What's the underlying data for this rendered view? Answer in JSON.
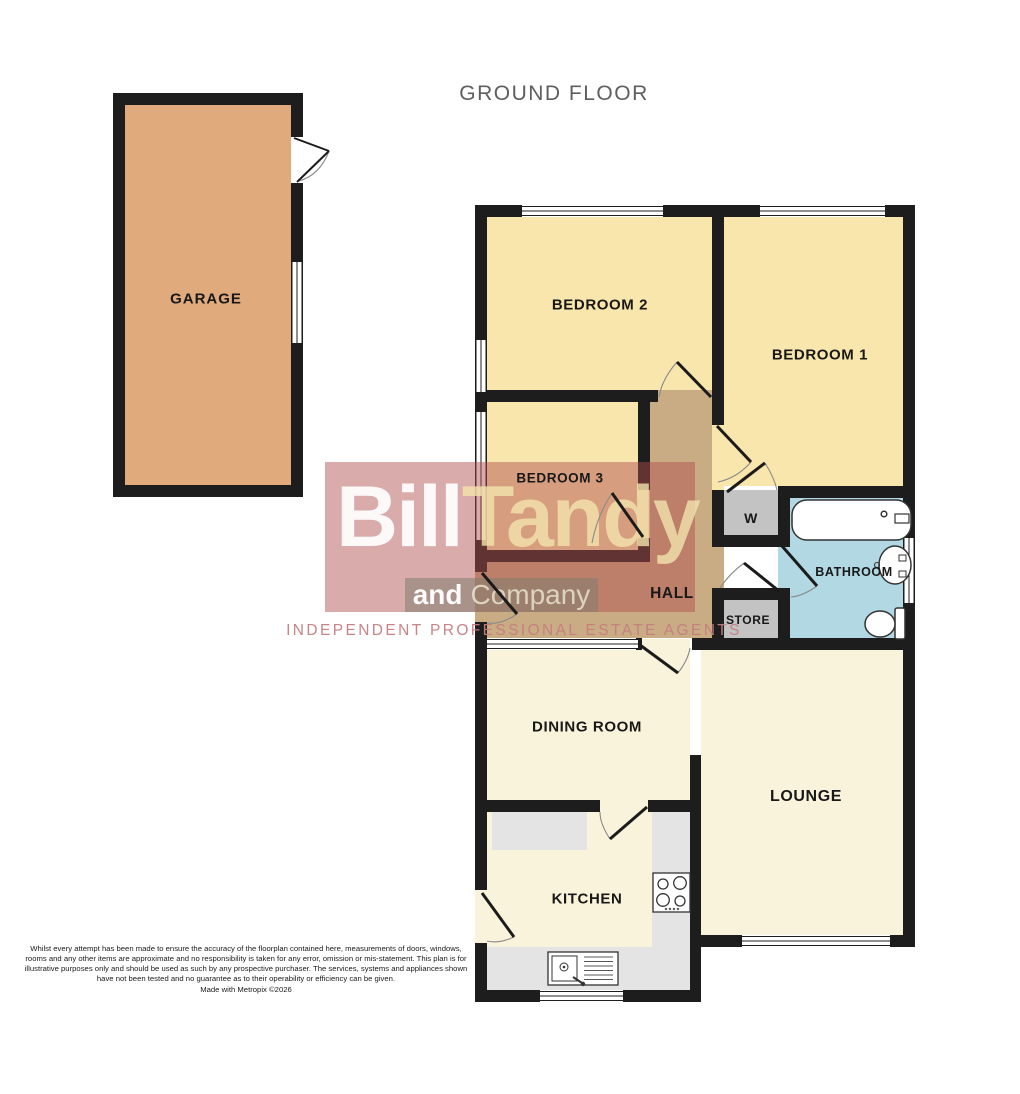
{
  "title": "GROUND FLOOR",
  "rooms": {
    "garage": "GARAGE",
    "bedroom2": "BEDROOM 2",
    "bedroom1": "BEDROOM 1",
    "bedroom3": "BEDROOM 3",
    "wardrobe": "W",
    "bathroom": "BATHROOM",
    "hall": "HALL",
    "store": "STORE",
    "dining": "DINING ROOM",
    "lounge": "LOUNGE",
    "kitchen": "KITCHEN"
  },
  "watermark": {
    "brand_first": "Bill",
    "brand_second": "Tandy",
    "subtitle_bold": "and",
    "subtitle_rest": "Company",
    "tagline": "INDEPENDENT PROFESSIONAL ESTATE AGENTS"
  },
  "disclaimer": {
    "text": "Whilst every attempt has been made to ensure the accuracy of the floorplan contained here, measurements of doors, windows, rooms and any other items are approximate and no responsibility is taken for any error, omission or mis-statement. This plan is for illustrative purposes only and should be used as such by any prospective purchaser. The services, systems and appliances shown have not been tested and no guarantee as to their operability or efficiency can be given.",
    "credit": "Made with Metropix ©2026"
  },
  "colors": {
    "room_cream": "#f8e6ac",
    "room_pale": "#faf3dc",
    "garage_tan": "#e0aa7d",
    "hall_tan": "#c9ac83",
    "bathroom_blue": "#b2d9e3",
    "closet_gray": "#c3c3c3",
    "counter_gray": "#e4e4e4",
    "wall": "#1d1d1d",
    "watermark_red": "#b04d4d"
  }
}
